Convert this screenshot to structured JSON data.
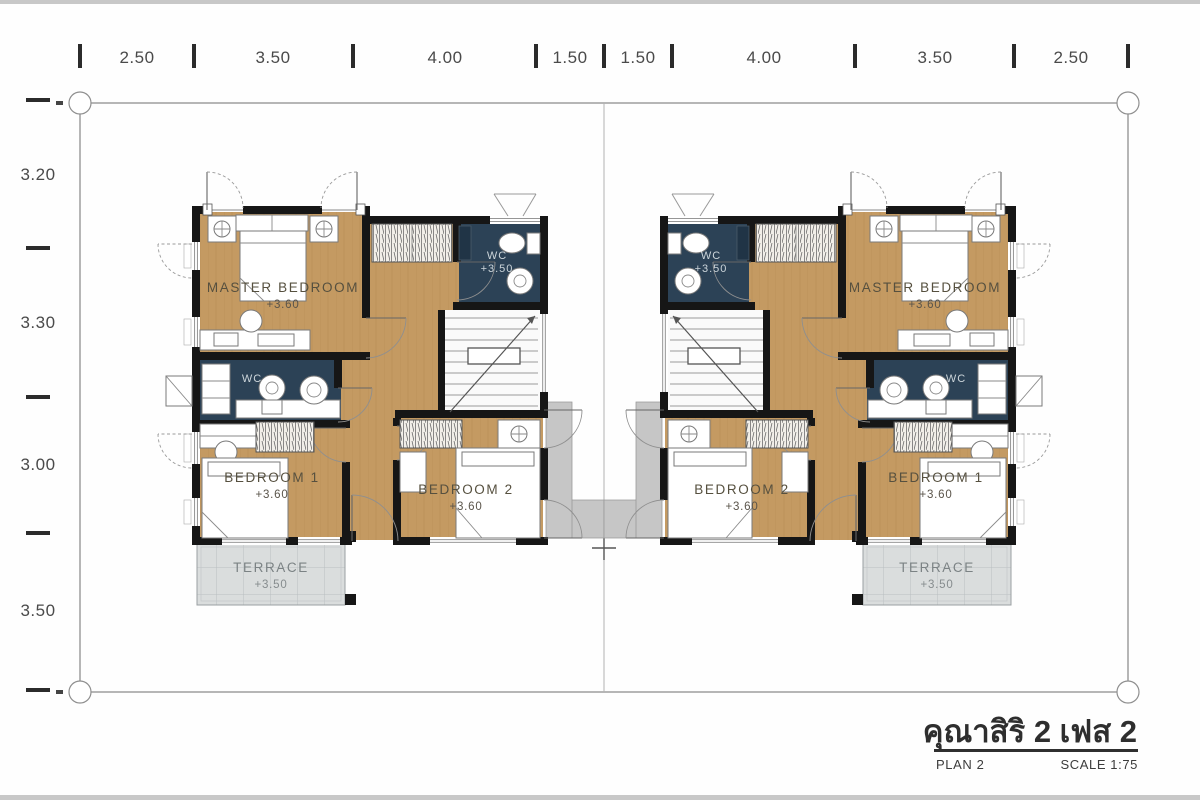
{
  "title_block": {
    "project": "คุณาสิริ 2 เฟส 2",
    "plan": "PLAN 2",
    "scale": "SCALE 1:75"
  },
  "dimensions": {
    "top": [
      "2.50",
      "3.50",
      "4.00",
      "1.50",
      "1.50",
      "4.00",
      "3.50",
      "2.50"
    ],
    "left": [
      "3.20",
      "3.30",
      "3.00",
      "3.50"
    ]
  },
  "rooms": {
    "master_bedroom": {
      "label": "MASTER BEDROOM",
      "level": "+3.60"
    },
    "wc": {
      "label": "WC",
      "level": "+3.50"
    },
    "bedroom1": {
      "label": "BEDROOM 1",
      "level": "+3.60"
    },
    "bedroom2": {
      "label": "BEDROOM 2",
      "level": "+3.60"
    },
    "terrace": {
      "label": "TERRACE",
      "level": "+3.50"
    }
  },
  "colors": {
    "wall": "#161616",
    "wood": "#c49a62",
    "wc": "#2c4256",
    "terrace": "#dadddd",
    "walkway": "#c6c6c6",
    "frame": "#c8c8c8"
  }
}
